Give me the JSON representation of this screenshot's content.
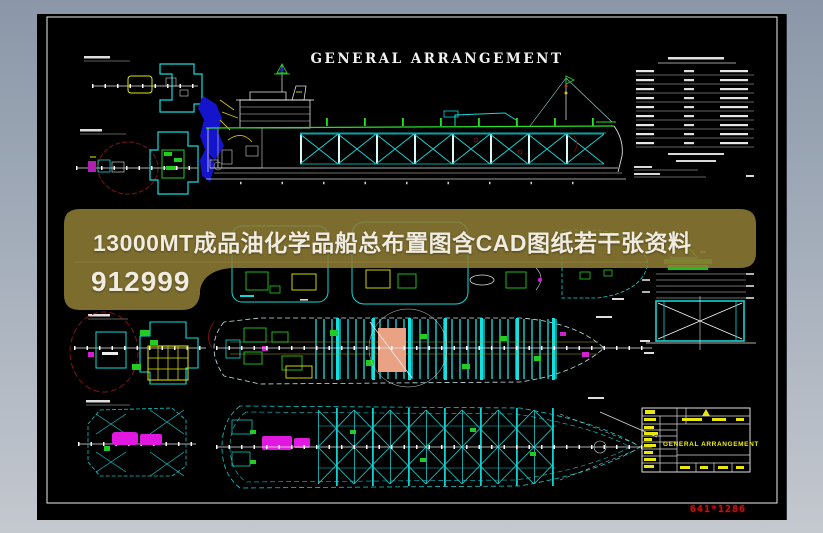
{
  "window": {
    "frame_gradient_top": "#8b97a8",
    "frame_gradient_bottom": "#c4c8cf",
    "canvas_color": "#000000"
  },
  "sheet": {
    "title": "GENERAL ARRANGEMENT",
    "border_color": "#c8c8c8"
  },
  "overlay_banner": {
    "line1": "13000MT成品油化学品船总布置图含CAD图纸若干张资料",
    "line2": "912999",
    "fill_color": "#8d7c35",
    "text_color": "#f0ece1"
  },
  "title_block": {
    "drawing_title": "GENERAL ARRANGEMENT",
    "text_color": "#f0f012"
  },
  "footer": {
    "size_label": "641*1286",
    "color": "#c01010"
  },
  "palette": {
    "cad_cyan": "#12d8d8",
    "cad_green": "#22cc22",
    "cad_yellow": "#e8e800",
    "cad_magenta": "#e018e0",
    "cad_salmon": "#eaa284",
    "cad_blue": "#1414cc",
    "revision_cloud_red": "#7d1414",
    "cad_white": "#e8e8e8"
  }
}
